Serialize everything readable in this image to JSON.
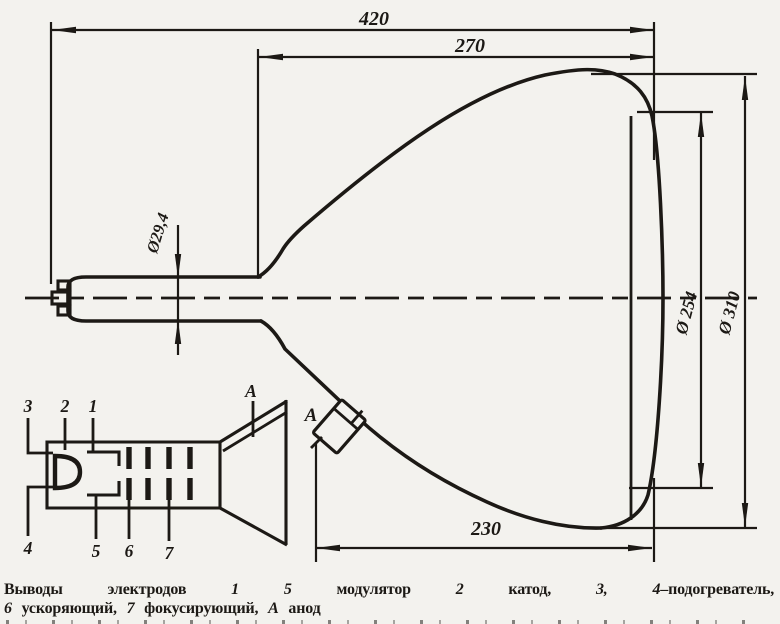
{
  "colors": {
    "ink": "#1c1915",
    "paper": "#f3f2ee"
  },
  "dims": {
    "overall_length": "420",
    "bulb_section_length": "270",
    "cone_length": "230",
    "neck_diameter": "Ø29,4",
    "screen_diameter": "Ø 254",
    "max_diameter": "Ø 310"
  },
  "anode": {
    "label": "A"
  },
  "inset": {
    "pin1": "1",
    "pin2": "2",
    "pin3": "3",
    "pin4": "4",
    "pin5": "5",
    "pin6": "6",
    "pin7": "7",
    "anode": "A"
  },
  "caption": {
    "line1": [
      {
        "t": "Выводы электродов "
      },
      {
        "t": "1 5",
        "i": true
      },
      {
        "t": " модулятор "
      },
      {
        "t": "2",
        "i": true
      },
      {
        "t": " катод, "
      },
      {
        "t": "3, 4",
        "i": true
      },
      {
        "t": "–подогреватель,"
      }
    ],
    "line2": [
      {
        "t": "6",
        "i": true
      },
      {
        "t": " ускоряющий, "
      },
      {
        "t": "7",
        "i": true
      },
      {
        "t": " фокусирующий, "
      },
      {
        "t": "А",
        "i": true
      },
      {
        "t": " анод"
      }
    ]
  }
}
